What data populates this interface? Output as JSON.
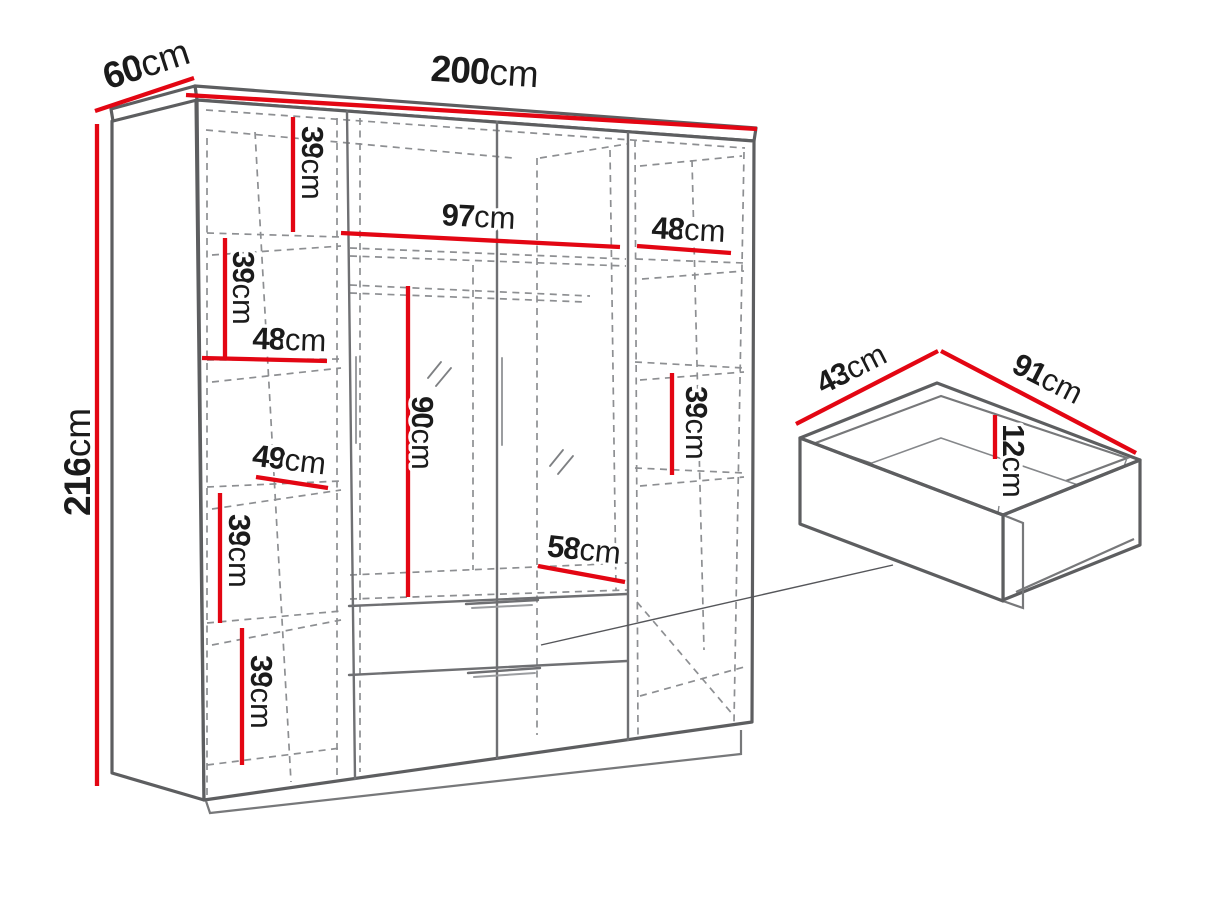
{
  "diagram": {
    "subject": "Wardrobe with drawer detail - dimension drawing",
    "colors": {
      "dimension_lines": "#e30613",
      "solid_edges": "#5d5e60",
      "hidden_edges": "#8d8f92",
      "label_text": "#1b1b1b",
      "background": "#ffffff"
    }
  },
  "wardrobe": {
    "overall_width": {
      "value": "200",
      "unit": "cm"
    },
    "overall_depth": {
      "value": "60",
      "unit": "cm"
    },
    "overall_height": {
      "value": "216",
      "unit": "cm"
    },
    "left_column": {
      "shelf_gap_1": {
        "value": "39",
        "unit": "cm"
      },
      "shelf_gap_2": {
        "value": "39",
        "unit": "cm"
      },
      "shelf_width_upper": {
        "value": "48",
        "unit": "cm"
      },
      "shelf_width_lower": {
        "value": "49",
        "unit": "cm"
      },
      "shelf_gap_3": {
        "value": "39",
        "unit": "cm"
      },
      "shelf_gap_4": {
        "value": "39",
        "unit": "cm"
      }
    },
    "middle_section": {
      "interior_width": {
        "value": "97",
        "unit": "cm"
      },
      "hanging_height": {
        "value": "90",
        "unit": "cm"
      },
      "bottom_depth": {
        "value": "58",
        "unit": "cm"
      }
    },
    "right_column": {
      "shelf_width": {
        "value": "48",
        "unit": "cm"
      },
      "shelf_gap": {
        "value": "39",
        "unit": "cm"
      }
    }
  },
  "drawer": {
    "depth": {
      "value": "43",
      "unit": "cm"
    },
    "width": {
      "value": "91",
      "unit": "cm"
    },
    "height": {
      "value": "12",
      "unit": "cm"
    }
  }
}
